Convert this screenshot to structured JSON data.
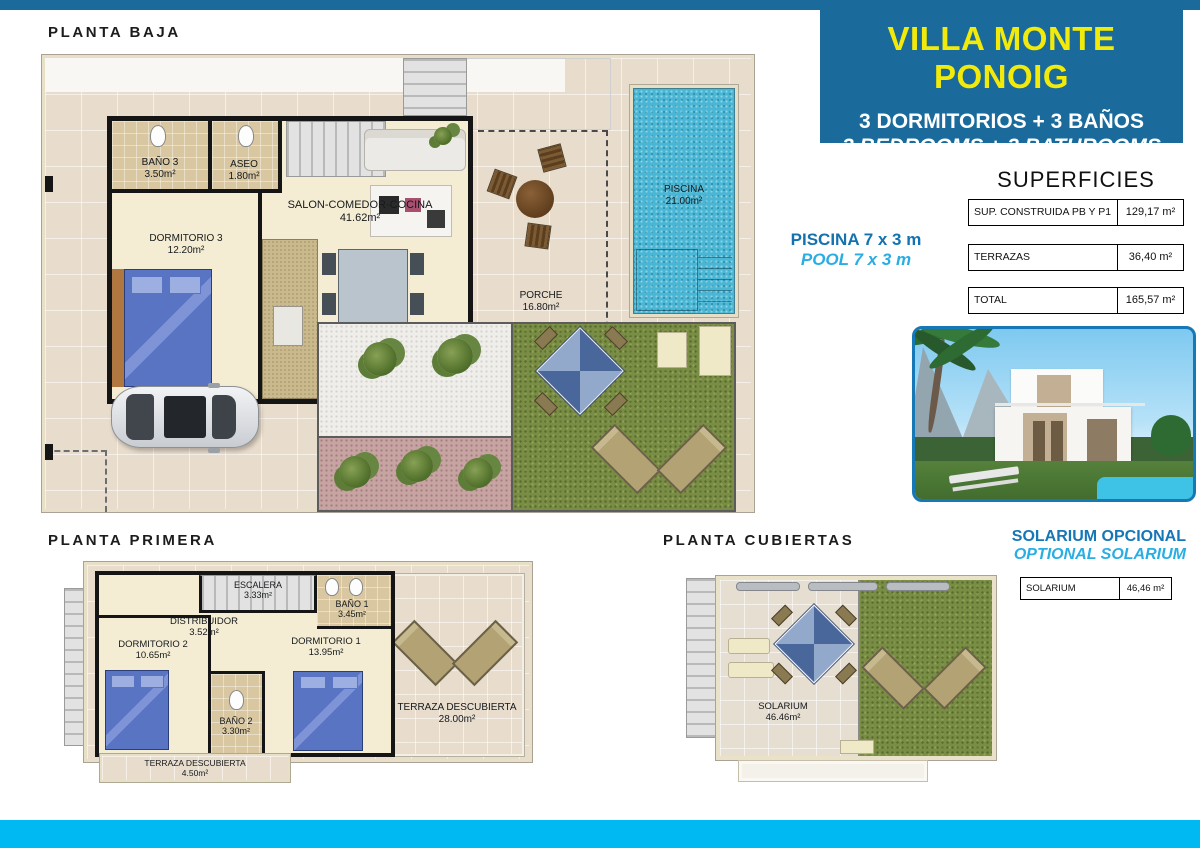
{
  "header": {
    "title": "VILLA MONTE PONOIG",
    "subtitle_es": "3 DORMITORIOS + 3 BAÑOS",
    "subtitle_en": "3 BEDROOMS + 3 BATHROOMS"
  },
  "sections": {
    "baja_title": "PLANTA BAJA",
    "primera_title": "PLANTA PRIMERA",
    "cubiertas_title": "PLANTA CUBIERTAS"
  },
  "pool_note": {
    "es": "PISCINA 7 x 3 m",
    "en": "POOL 7 x 3 m"
  },
  "solarium_note": {
    "es": "SOLARIUM OPCIONAL",
    "en": "OPTIONAL SOLARIUM"
  },
  "superficies": {
    "title": "SUPERFICIES",
    "rows": [
      {
        "label": "SUP. CONSTRUIDA PB Y P1",
        "value": "129,17 m²"
      },
      {
        "label": "TERRAZAS",
        "value": "36,40 m²"
      },
      {
        "label": "TOTAL",
        "value": "165,57 m²"
      }
    ]
  },
  "solarium_table": {
    "label": "SOLARIUM",
    "value": "46,46 m²"
  },
  "rooms": {
    "baja": {
      "bano3": {
        "name": "BAÑO 3",
        "area": "3.50m²"
      },
      "aseo": {
        "name": "ASEO",
        "area": "1.80m²"
      },
      "salon": {
        "name": "SALON-COMEDOR-COCINA",
        "area": "41.62m²"
      },
      "dormitorio3": {
        "name": "DORMITORIO 3",
        "area": "12.20m²"
      },
      "porche": {
        "name": "PORCHE",
        "area": "16.80m²"
      },
      "piscina": {
        "name": "PISCINA",
        "area": "21.00m²"
      }
    },
    "primera": {
      "escalera": {
        "name": "ESCALERA",
        "area": "3.33m²"
      },
      "distribuidor": {
        "name": "DISTRIBUIDOR",
        "area": "3.52m²"
      },
      "bano1": {
        "name": "BAÑO 1",
        "area": "3.45m²"
      },
      "dormitorio1": {
        "name": "DORMITORIO 1",
        "area": "13.95m²"
      },
      "dormitorio2": {
        "name": "DORMITORIO 2",
        "area": "10.65m²"
      },
      "bano2": {
        "name": "BAÑO 2",
        "area": "3.30m²"
      },
      "terraza": {
        "name": "TERRAZA DESCUBIERTA",
        "area": "28.00m²"
      },
      "terraza_small": {
        "name": "TERRAZA DESCUBIERTA",
        "area": "4.50m²"
      }
    },
    "cubiertas": {
      "solarium": {
        "name": "SOLARIUM",
        "area": "46.46m²"
      }
    }
  },
  "colors": {
    "accent_blue": "#1a6b9c",
    "accent_cyan": "#00b9f2",
    "title_yellow": "#f2ea0a",
    "note_blue": "#1472ae",
    "note_cyan": "#29aee4"
  }
}
